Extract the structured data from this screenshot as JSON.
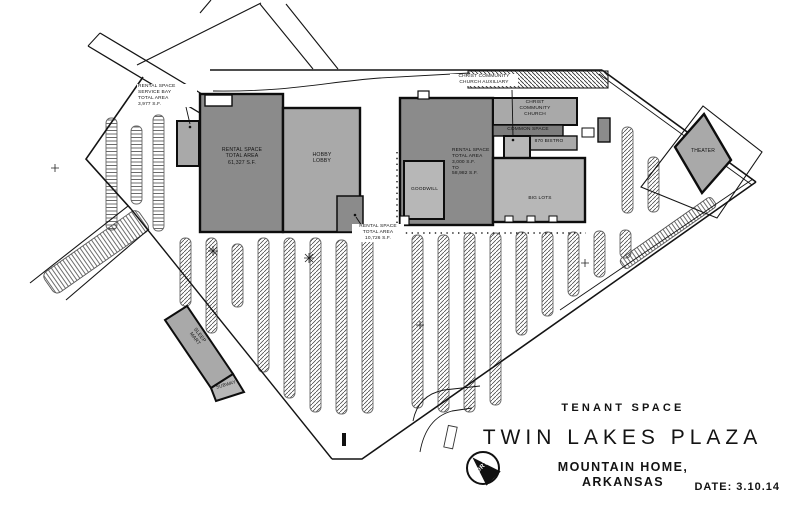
{
  "drawing": {
    "title_block": {
      "subtitle": "TENANT SPACE",
      "title": "TWIN LAKES PLAZA",
      "location": "MOUNTAIN HOME, ARKANSAS",
      "date": "DATE: 3.10.14",
      "north": "NORTH"
    },
    "labels": {
      "service_bay": "RENTAL SPACE\nSERVICE BAY\nTOTAL AREA\n3,977 S.F.",
      "rental_main": "RENTAL SPACE\nTOTAL AREA\n61,327 S.F.",
      "hobby_lobby": "HOBBY\nLOBBY",
      "rental_small": "RENTAL SPACE\nTOTAL AREA\n10,726 S.F.",
      "church_aux": "CHRIST COMMUNITY\nCHURCH AUXILIARY",
      "church": "CHRIST\nCOMMUNITY\nCHURCH",
      "common_space": "COMMON SPACE",
      "bistro": "870 BISTRO",
      "rental_range": "RENTAL SPACE\nTOTAL AREA\n3,000 S.F.\nTO\n58,982 S.F.",
      "goodwill": "GOODWILL",
      "big_lots": "BIG LOTS",
      "theater": "THEATER",
      "sleep_mart": "SLEEP\nMART",
      "subway": "SUBWAY"
    },
    "colors": {
      "building_dark": "#8b8b8b",
      "building_medium": "#a9a9a9",
      "building_light": "#b7b7b7",
      "common_strip": "#7d7d7d",
      "linework": "#141414"
    }
  }
}
